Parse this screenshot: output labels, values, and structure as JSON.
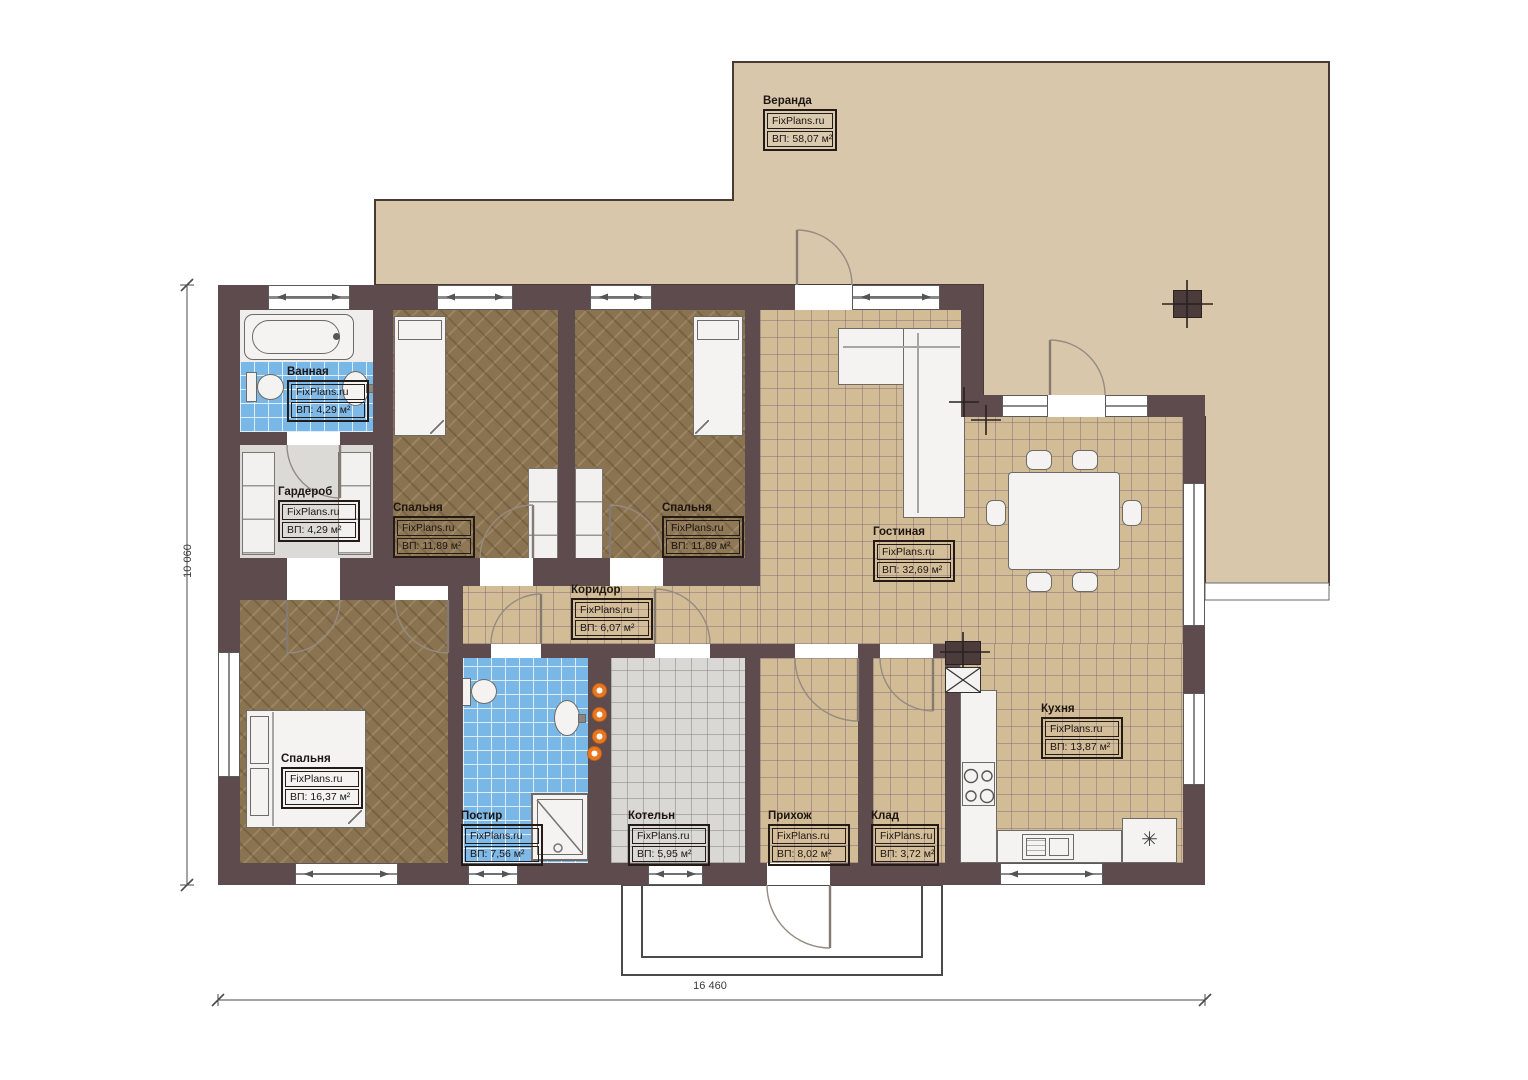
{
  "plan": {
    "brand": "FixPlans.ru",
    "rooms": [
      {
        "name": "Веранда",
        "area": "ВП: 58,07 м²"
      },
      {
        "name": "Ванная",
        "area": "ВП: 4,29 м²"
      },
      {
        "name": "Гардероб",
        "area": "ВП: 4,29 м²"
      },
      {
        "name": "Спальня",
        "area": "ВП: 11,89 м²"
      },
      {
        "name": "Спальня",
        "area": "ВП: 11,89 м²"
      },
      {
        "name": "Гостиная",
        "area": "ВП: 32,69 м²"
      },
      {
        "name": "Коридор",
        "area": "ВП: 6,07 м²"
      },
      {
        "name": "Спальня",
        "area": "ВП: 16,37 м²"
      },
      {
        "name": "Постир",
        "area": "ВП: 7,56 м²"
      },
      {
        "name": "Котельн",
        "area": "ВП: 5,95 м²"
      },
      {
        "name": "Прихож",
        "area": "ВП: 8,02 м²"
      },
      {
        "name": "Клад",
        "area": "ВП: 3,72 м²"
      },
      {
        "name": "Кухня",
        "area": "ВП: 13,87 м²"
      }
    ],
    "dimensions": {
      "bottom": "16 460",
      "left": "10 060"
    },
    "icons": {
      "fridge": "✳"
    },
    "colors": {
      "walls": "#5d4b4d",
      "tile_floor": "#d2bc95",
      "wood_floor": "#8a7350",
      "blue_tile": "#79b7e6",
      "gray_tile": "#d9d8d5",
      "veranda": "#d8c7ab",
      "accent_orange": "#e87722"
    }
  }
}
